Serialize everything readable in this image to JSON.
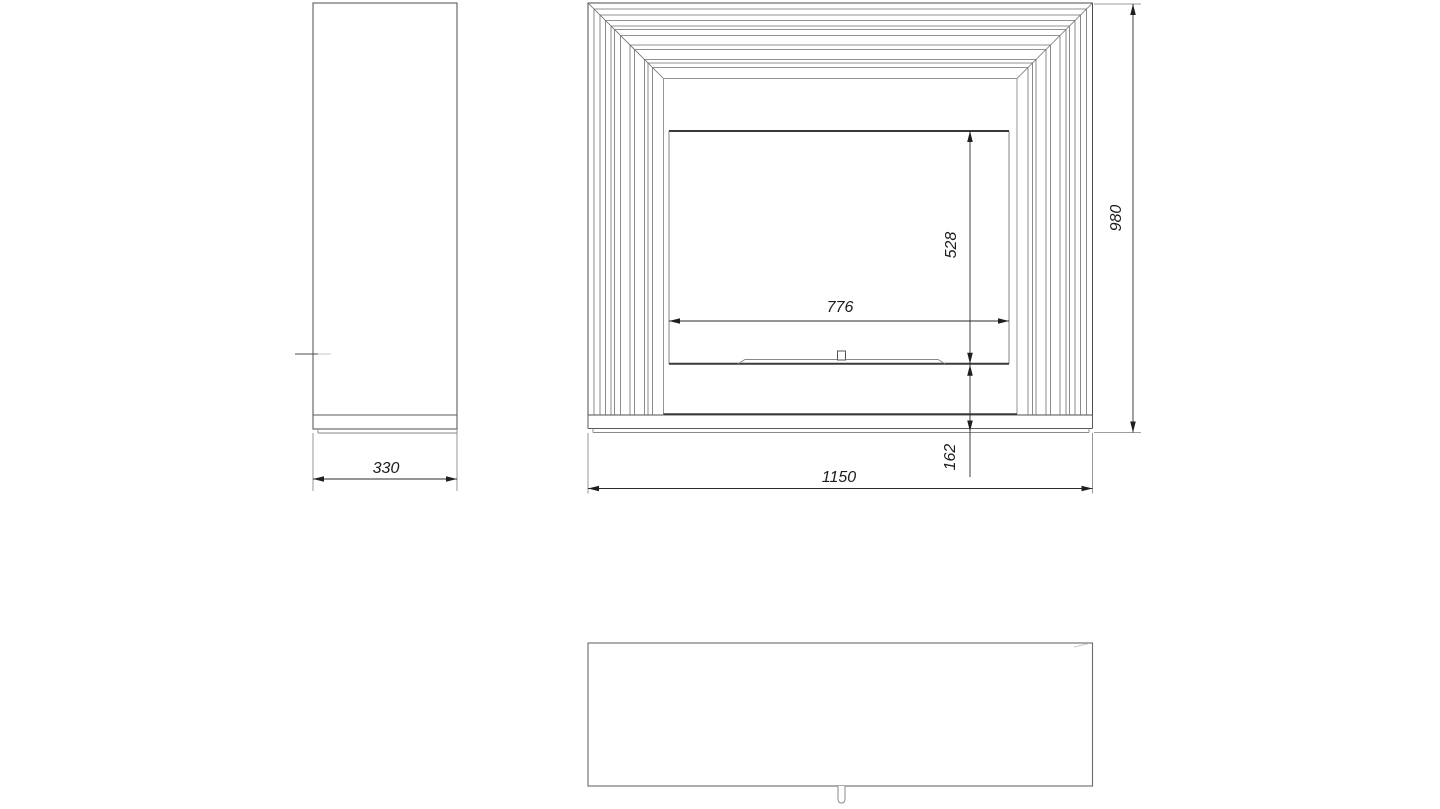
{
  "page": {
    "background": "#ffffff",
    "kind": "technical-drawing"
  },
  "drawing": {
    "dimensions": {
      "side_depth": "330",
      "overall_width": "1150",
      "overall_height": "980",
      "opening_width": "776",
      "opening_height": "528",
      "base_height": "162"
    },
    "colors": {
      "outline": "#4d4d4d",
      "slat": "#6e6e6e",
      "dimension": "#2b2b2b",
      "label": "#1c1c1c"
    },
    "frame": {
      "x1": 588,
      "y1": 3,
      "x2": 1092.5,
      "bottom": 415,
      "inner_offset": 75.5
    },
    "slat_offsets": [
      6,
      12,
      17.5,
      23,
      26.5,
      32.5,
      42,
      46.5,
      56.5,
      60,
      64.5
    ]
  }
}
